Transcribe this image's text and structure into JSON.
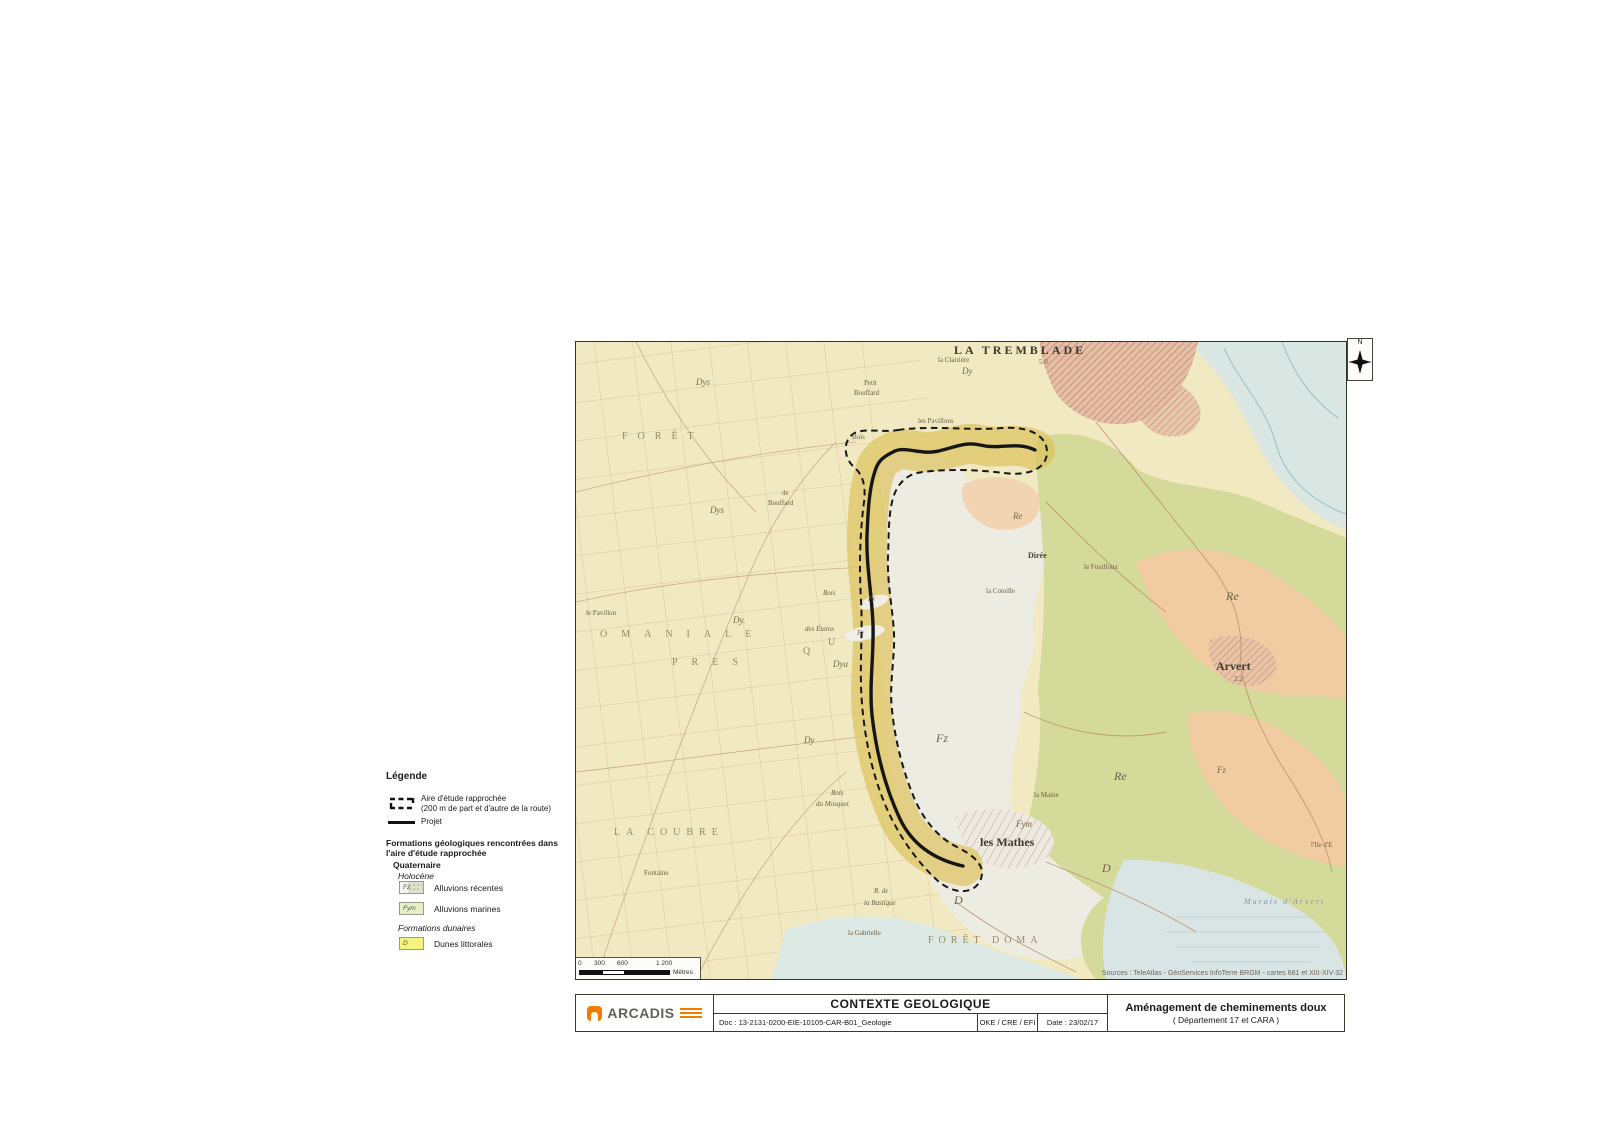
{
  "colors": {
    "map_base": "#F0E9C1",
    "corridor_yellow": "#DDC35C",
    "alluvions_white": "#EDECE3",
    "green_marsh": "#D4DA99",
    "orange_limestone": "#F1CCA3",
    "water_blue": "#D9E6E2",
    "town_pink_hatch": "#E3BFA8",
    "route_black": "#161616",
    "arcadis_orange": "#F07D00"
  },
  "legend": {
    "title": "Légende",
    "study_area_line1": "Aire d'étude rapprochée",
    "study_area_line2": "(200 m de part et d'autre de la route)",
    "project_label": "Projet",
    "formations_heading_line1": "Formations géologiques rencontrées dans",
    "formations_heading_line2": "l'aire d'étude rapprochée",
    "group_quaternaire": "Quaternaire",
    "group_holocene": "Holocène",
    "items": [
      {
        "code": "Fz",
        "label": "Alluvions récentes"
      },
      {
        "code": "Fym",
        "label": "Alluvions marines"
      }
    ],
    "group_dunaires": "Formations dunaires",
    "dunes_code": "D",
    "dunes_label": "Dunes littorales"
  },
  "map": {
    "north_label": "N",
    "sources": "Sources : TeleAtlas - GéoServices InfoTerre BRGM - cartes 681 et XIII-XIV-32",
    "scalebar": {
      "t0": "0",
      "t1": "300",
      "t2": "600",
      "t3": "1 200",
      "unit": "Mètres"
    },
    "labels": [
      {
        "text": "LA TREMBLADE",
        "x": 378,
        "y": 2,
        "cls": "town-big"
      },
      {
        "text": "la Clairière",
        "x": 362,
        "y": 15,
        "cls": "tiny"
      },
      {
        "text": "5.0",
        "x": 463,
        "y": 17,
        "cls": "tiny"
      },
      {
        "text": "Dy",
        "x": 386,
        "y": 25,
        "cls": "geo"
      },
      {
        "text": "Dys",
        "x": 120,
        "y": 36,
        "cls": "geo"
      },
      {
        "text": "Petit",
        "x": 288,
        "y": 38,
        "cls": "tiny"
      },
      {
        "text": "Bouffard",
        "x": 278,
        "y": 48,
        "cls": "tiny"
      },
      {
        "text": "les Pavillons",
        "x": 342,
        "y": 76,
        "cls": "tiny"
      },
      {
        "text": "FORÊT",
        "x": 46,
        "y": 90,
        "cls": "forest",
        "ls": 10
      },
      {
        "text": "Bois",
        "x": 276,
        "y": 92,
        "cls": "tiny"
      },
      {
        "text": "de",
        "x": 206,
        "y": 148,
        "cls": "tiny"
      },
      {
        "text": "Bouffard",
        "x": 192,
        "y": 158,
        "cls": "tiny"
      },
      {
        "text": "Dys",
        "x": 134,
        "y": 164,
        "cls": "geo"
      },
      {
        "text": "Re",
        "x": 437,
        "y": 170,
        "cls": "geo"
      },
      {
        "text": "Dirée",
        "x": 452,
        "y": 210,
        "cls": "small-dark"
      },
      {
        "text": "le Fouilloux",
        "x": 508,
        "y": 222,
        "cls": "tiny"
      },
      {
        "text": "la Coteille",
        "x": 410,
        "y": 246,
        "cls": "tiny"
      },
      {
        "text": "Bois",
        "x": 247,
        "y": 248,
        "cls": "tiny-i"
      },
      {
        "text": "Fz",
        "x": 292,
        "y": 254,
        "cls": "geo-s"
      },
      {
        "text": "le Pavillon",
        "x": 10,
        "y": 268,
        "cls": "tiny"
      },
      {
        "text": "Dy.",
        "x": 157,
        "y": 274,
        "cls": "geo"
      },
      {
        "text": "des Étains",
        "x": 229,
        "y": 284,
        "cls": "tiny-i"
      },
      {
        "text": "Fz",
        "x": 281,
        "y": 288,
        "cls": "geo-s"
      },
      {
        "text": "OMANIALE",
        "x": 24,
        "y": 288,
        "cls": "forest",
        "ls": 14
      },
      {
        "text": "U",
        "x": 252,
        "y": 296,
        "cls": "forest"
      },
      {
        "text": "Q",
        "x": 227,
        "y": 305,
        "cls": "forest"
      },
      {
        "text": "PRES",
        "x": 96,
        "y": 316,
        "cls": "forest",
        "ls": 14
      },
      {
        "text": "Dya",
        "x": 257,
        "y": 318,
        "cls": "geo"
      },
      {
        "text": "Re",
        "x": 650,
        "y": 248,
        "cls": "geo-b"
      },
      {
        "text": "Arvert",
        "x": 640,
        "y": 318,
        "cls": "town-med"
      },
      {
        "text": "2.2",
        "x": 658,
        "y": 334,
        "cls": "tiny"
      },
      {
        "text": "Dy",
        "x": 228,
        "y": 394,
        "cls": "geo"
      },
      {
        "text": "Fz",
        "x": 360,
        "y": 390,
        "cls": "geo-b"
      },
      {
        "text": "Fz",
        "x": 641,
        "y": 424,
        "cls": "geo"
      },
      {
        "text": "Re",
        "x": 538,
        "y": 428,
        "cls": "geo-b"
      },
      {
        "text": "Bois",
        "x": 255,
        "y": 448,
        "cls": "tiny-i"
      },
      {
        "text": "du Mosquet",
        "x": 240,
        "y": 459,
        "cls": "tiny-i"
      },
      {
        "text": "la Maine",
        "x": 458,
        "y": 450,
        "cls": "tiny"
      },
      {
        "text": "Fym",
        "x": 440,
        "y": 478,
        "cls": "geo"
      },
      {
        "text": "LA  COUBRE",
        "x": 38,
        "y": 486,
        "cls": "forest",
        "ls": 6
      },
      {
        "text": "les Mathes",
        "x": 404,
        "y": 494,
        "cls": "town-med"
      },
      {
        "text": "l'Ile d'E",
        "x": 735,
        "y": 500,
        "cls": "tiny"
      },
      {
        "text": "D",
        "x": 526,
        "y": 520,
        "cls": "geo-b"
      },
      {
        "text": "Fontaine",
        "x": 68,
        "y": 528,
        "cls": "tiny"
      },
      {
        "text": "R. de",
        "x": 298,
        "y": 546,
        "cls": "tiny-i"
      },
      {
        "text": "D",
        "x": 378,
        "y": 552,
        "cls": "geo-b"
      },
      {
        "text": "Marais d'Arvert",
        "x": 668,
        "y": 556,
        "cls": "marais",
        "ls": 2
      },
      {
        "text": "la Bastique",
        "x": 288,
        "y": 558,
        "cls": "tiny-i"
      },
      {
        "text": "la Gabrielle",
        "x": 272,
        "y": 588,
        "cls": "tiny"
      },
      {
        "text": "FORÊT DOMA",
        "x": 352,
        "y": 594,
        "cls": "forest",
        "ls": 5
      }
    ]
  },
  "titleblock": {
    "logo_text": "ARCADIS",
    "map_title": "CONTEXTE GEOLOGIQUE",
    "doc_ref": "Doc : 13-2131-0200-EIE-10105-CAR-B01_Geologie",
    "authors": "OKE / CRE / EFI",
    "date": "Date : 23/02/17",
    "project_title": "Aménagement de cheminements doux",
    "project_subtitle": "( Département 17 et CARA )"
  }
}
